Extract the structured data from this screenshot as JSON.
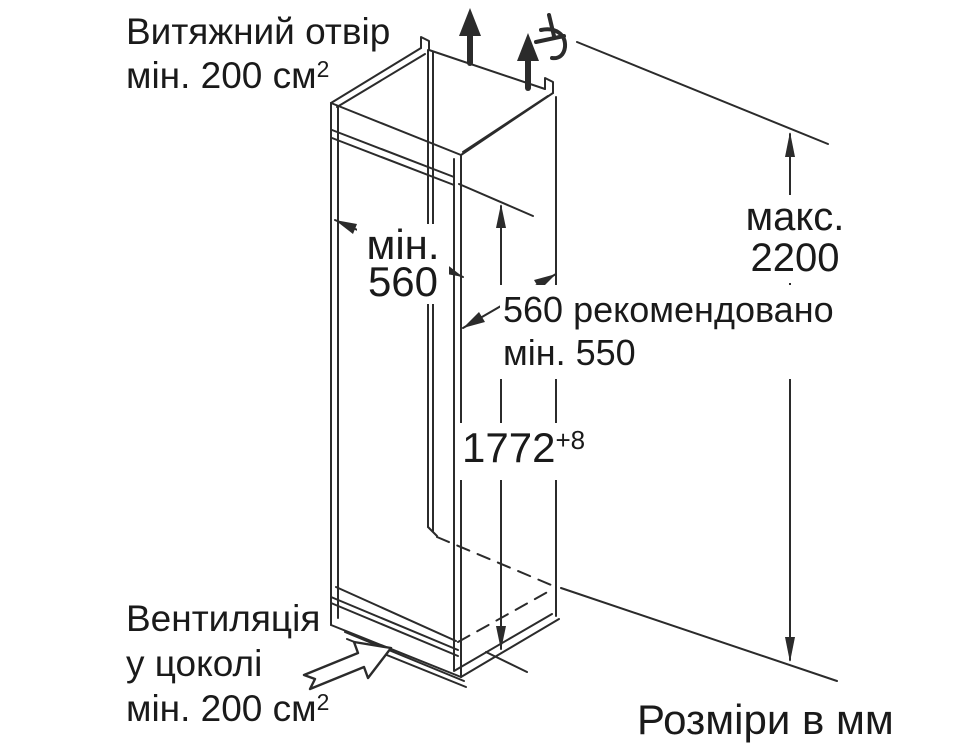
{
  "diagram": {
    "description_labels": {
      "exhaust_vent": {
        "line1": "Витяжний отвір",
        "line2": "мін. 200 см",
        "line2_sup": "2"
      },
      "niche_width": {
        "line1": "мін.",
        "line2": "560"
      },
      "niche_depth": {
        "line1": "560 рекомендовано",
        "line2": "мін. 550"
      },
      "niche_height": {
        "value": "1772",
        "tolerance": "+8"
      },
      "max_height": {
        "line1": "макс.",
        "line2": "2200"
      },
      "plinth_vent": {
        "line1": "Вентиляція",
        "line2": "у цоколі",
        "line3": "мін. 200 см",
        "line3_sup": "2"
      },
      "units": {
        "text": "Розміри в мм"
      }
    },
    "colors": {
      "background": "#ffffff",
      "line": "#2b2b2b",
      "text": "#1a1a1a"
    }
  }
}
